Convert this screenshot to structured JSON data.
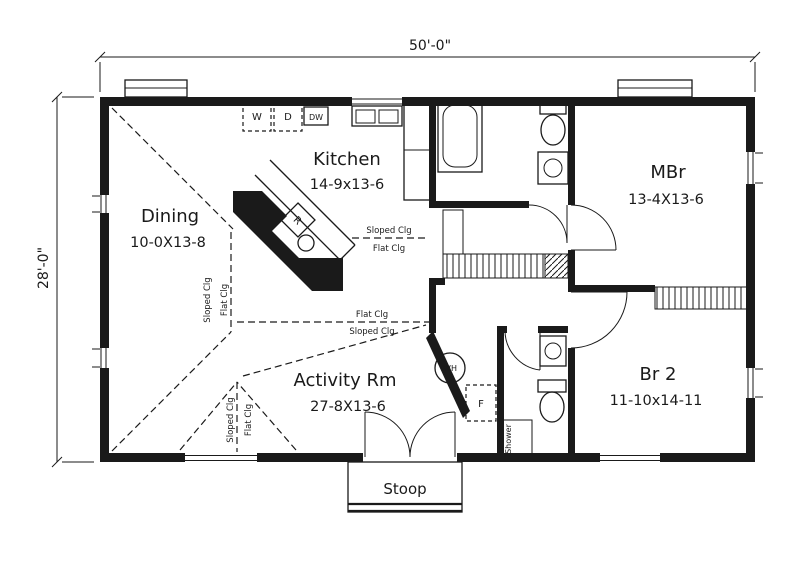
{
  "dimensions": {
    "width": "50'-0\"",
    "depth": "28'-0\""
  },
  "rooms": {
    "dining": {
      "name": "Dining",
      "size": "10-0X13-8"
    },
    "kitchen": {
      "name": "Kitchen",
      "size": "14-9x13-6"
    },
    "mbr": {
      "name": "MBr",
      "size": "13-4X13-6"
    },
    "activity": {
      "name": "Activity Rm",
      "size": "27-8X13-6"
    },
    "br2": {
      "name": "Br 2",
      "size": "11-10x14-11"
    }
  },
  "porch": {
    "stoop": "Stoop"
  },
  "ceiling": {
    "upper_above": "Sloped Clg",
    "upper_below": "Flat Clg",
    "lower_above": "Flat Clg",
    "lower_below": "Sloped Clg",
    "dining_left": "Sloped Clg",
    "dining_right": "Flat Clg",
    "activity_left": "Sloped Clg",
    "activity_right": "Flat Clg"
  },
  "fixtures": {
    "washer": "W",
    "dryer": "D",
    "dishwasher": "DW",
    "range": "R",
    "water_heater": "WH",
    "furnace": "F",
    "shower": "Shower"
  },
  "colors": {
    "ink": "#1a1a1a",
    "paper": "#ffffff"
  }
}
